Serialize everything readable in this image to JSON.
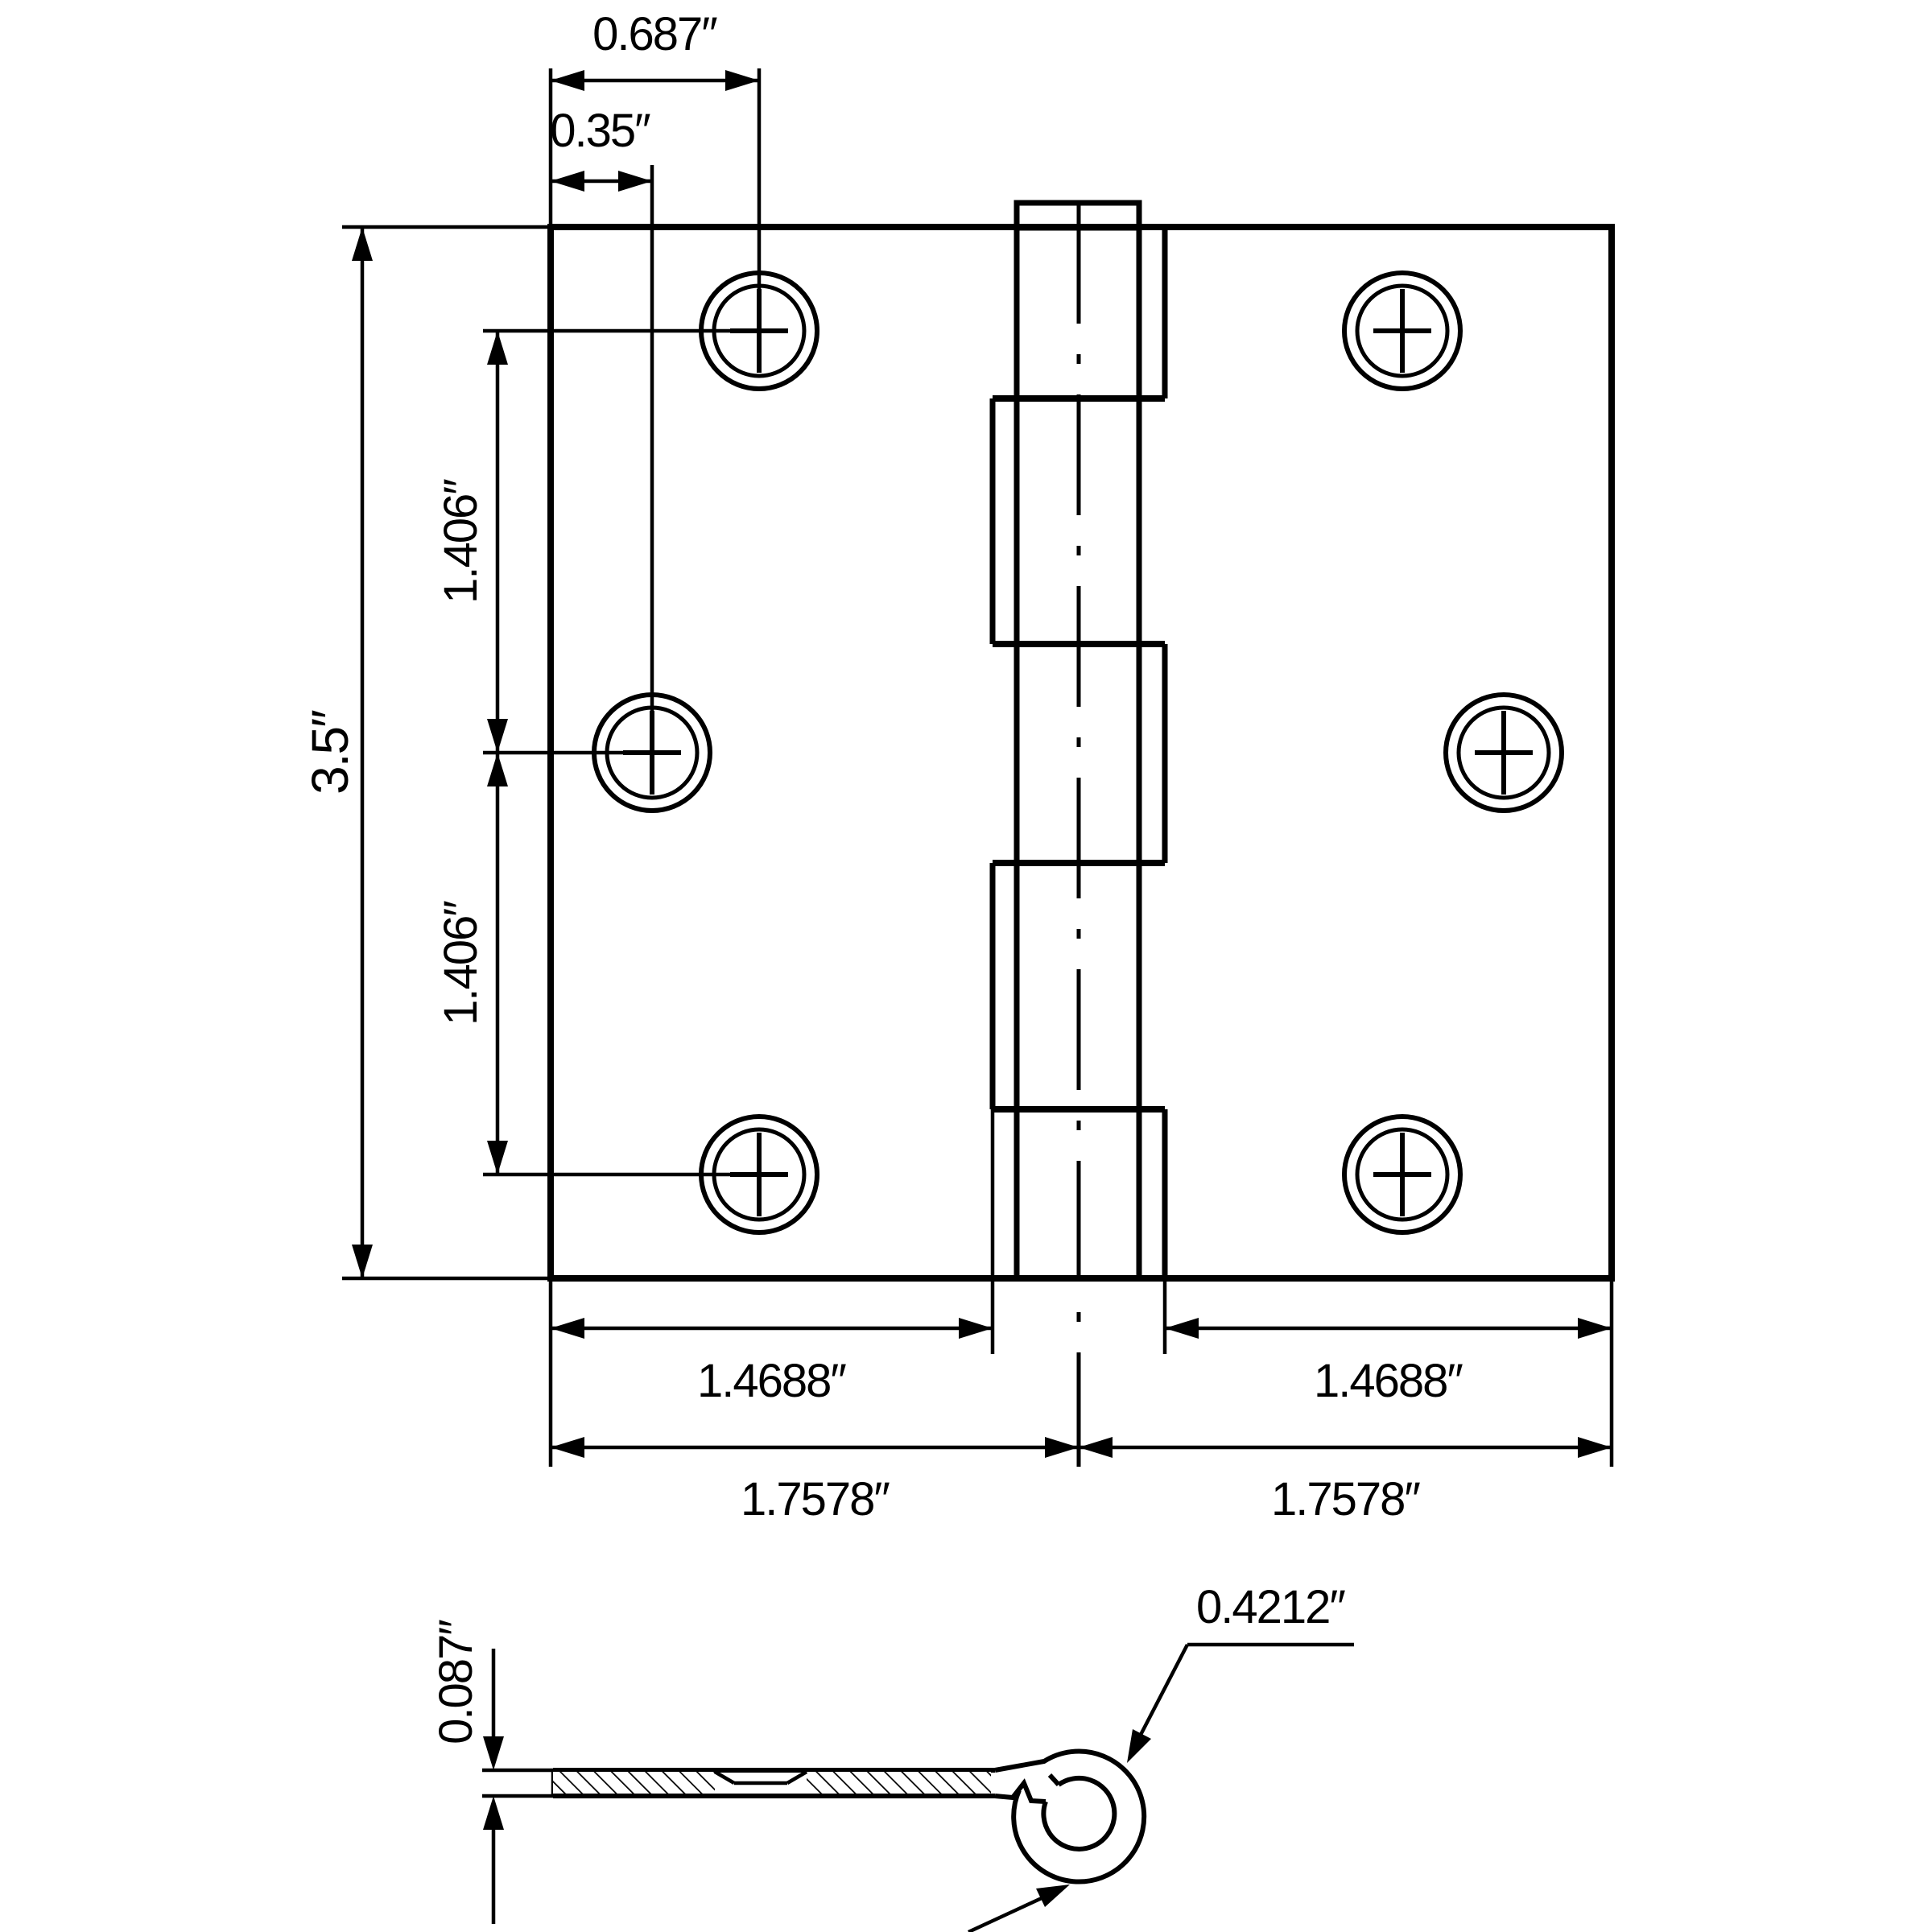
{
  "drawing": {
    "type": "engineering-dimension-drawing",
    "subject": "3.5 inch square-corner door hinge, open face view and cross-section profile",
    "background_color": "#ffffff",
    "line_color": "#000000"
  },
  "labels": {
    "top_hole_offset": "0.687″",
    "mid_hole_offset": "0.35″",
    "plate_height": "3.5″",
    "hole_spacing_upper": "1.406″",
    "hole_spacing_lower": "1.406″",
    "flat_width_left": "1.4688″",
    "flat_width_right": "1.4688″",
    "half_width_left": "1.7578″",
    "half_width_right": "1.7578″",
    "thickness": "0.087″",
    "knuckle_diameter": "0.4212″"
  }
}
